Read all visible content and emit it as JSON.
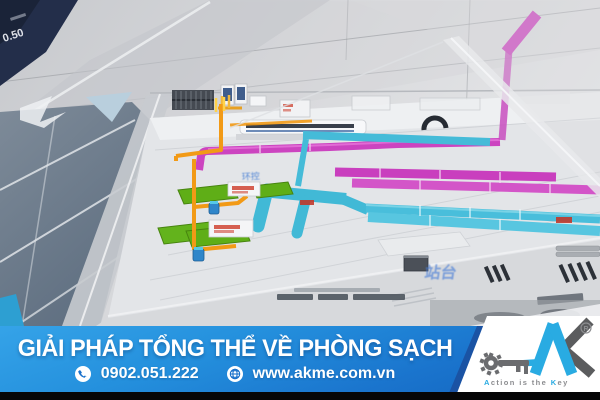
{
  "banner": {
    "headline": "GIẢI PHÁP TỔNG THỂ VỀ PHÒNG SẠCH",
    "phone": "0902.051.222",
    "website": "www.akme.com.vn",
    "bg_top_color": "#2f9de5",
    "bg_bottom_color": "#1263bd",
    "dark_band_color": "#1a53a4"
  },
  "logo": {
    "brand": "AK",
    "registered_mark": "®",
    "tagline": {
      "a": "A",
      "mid": "ction is the ",
      "k": "K",
      "ey": "ey"
    },
    "cyan": "#29abe2",
    "gray": "#58595b"
  },
  "photo": {
    "display_reading": "0.50",
    "label_env_control": "环控",
    "label_platform": "站台",
    "duct_magenta_color": "#cc44c0",
    "duct_cyan_color": "#45bbd8",
    "pipe_orange_color": "#f29a16",
    "panel_green_color": "#5fae17"
  }
}
